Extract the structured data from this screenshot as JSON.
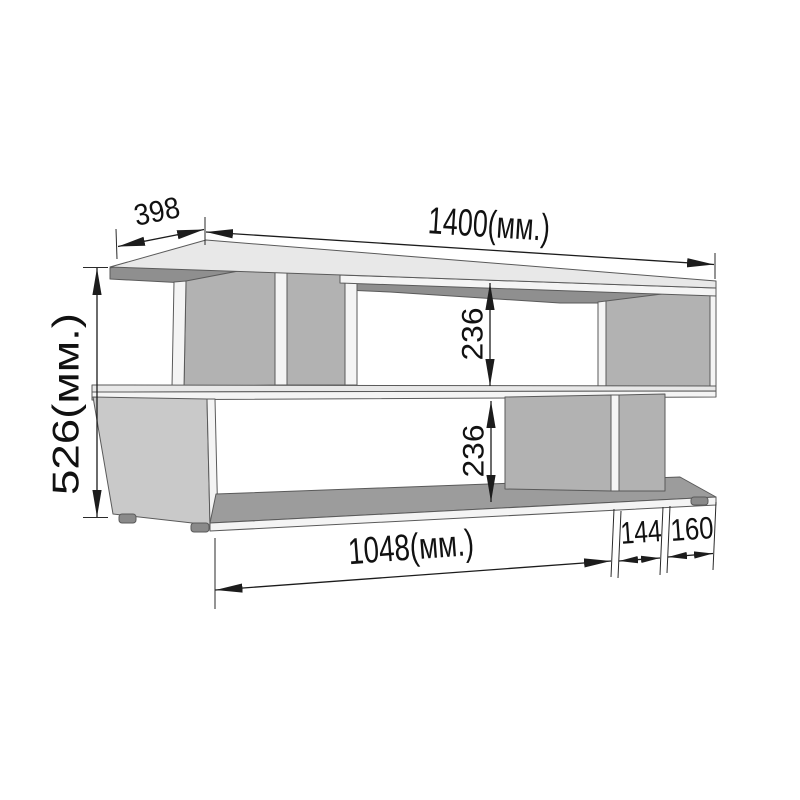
{
  "drawing": {
    "kind": "furniture dimensional diagram",
    "object": "z-shaped open shelf / tv stand shown in 3d view",
    "unit_suffix": "(мм.)",
    "dims": {
      "depth": {
        "label": "398",
        "mm": 398
      },
      "width": {
        "label": "1400(мм.)",
        "mm": 1400
      },
      "height": {
        "label": "526(мм.)",
        "mm": 526
      },
      "upper_opening": {
        "label": "236",
        "mm": 236
      },
      "lower_opening": {
        "label": "236",
        "mm": 236
      },
      "bottom_shelf": {
        "label": "1048(мм.)",
        "mm": 1048
      },
      "right_inner": {
        "label": "144",
        "mm": 144
      },
      "right_outer": {
        "label": "160",
        "mm": 160
      }
    },
    "colors": {
      "background": "#ffffff",
      "line": "#1c1c1c",
      "outline": "#5a5a5a",
      "top_face": "#e8e8e8",
      "edge_face": "#f4f4f4",
      "side_face": "#b2b2b2",
      "panel_face": "#c9c9c9",
      "underside": "#8f8f8f",
      "shelf_interior": "#9c9c9c",
      "foot": "#8a8a8a",
      "text": "#111111"
    }
  }
}
